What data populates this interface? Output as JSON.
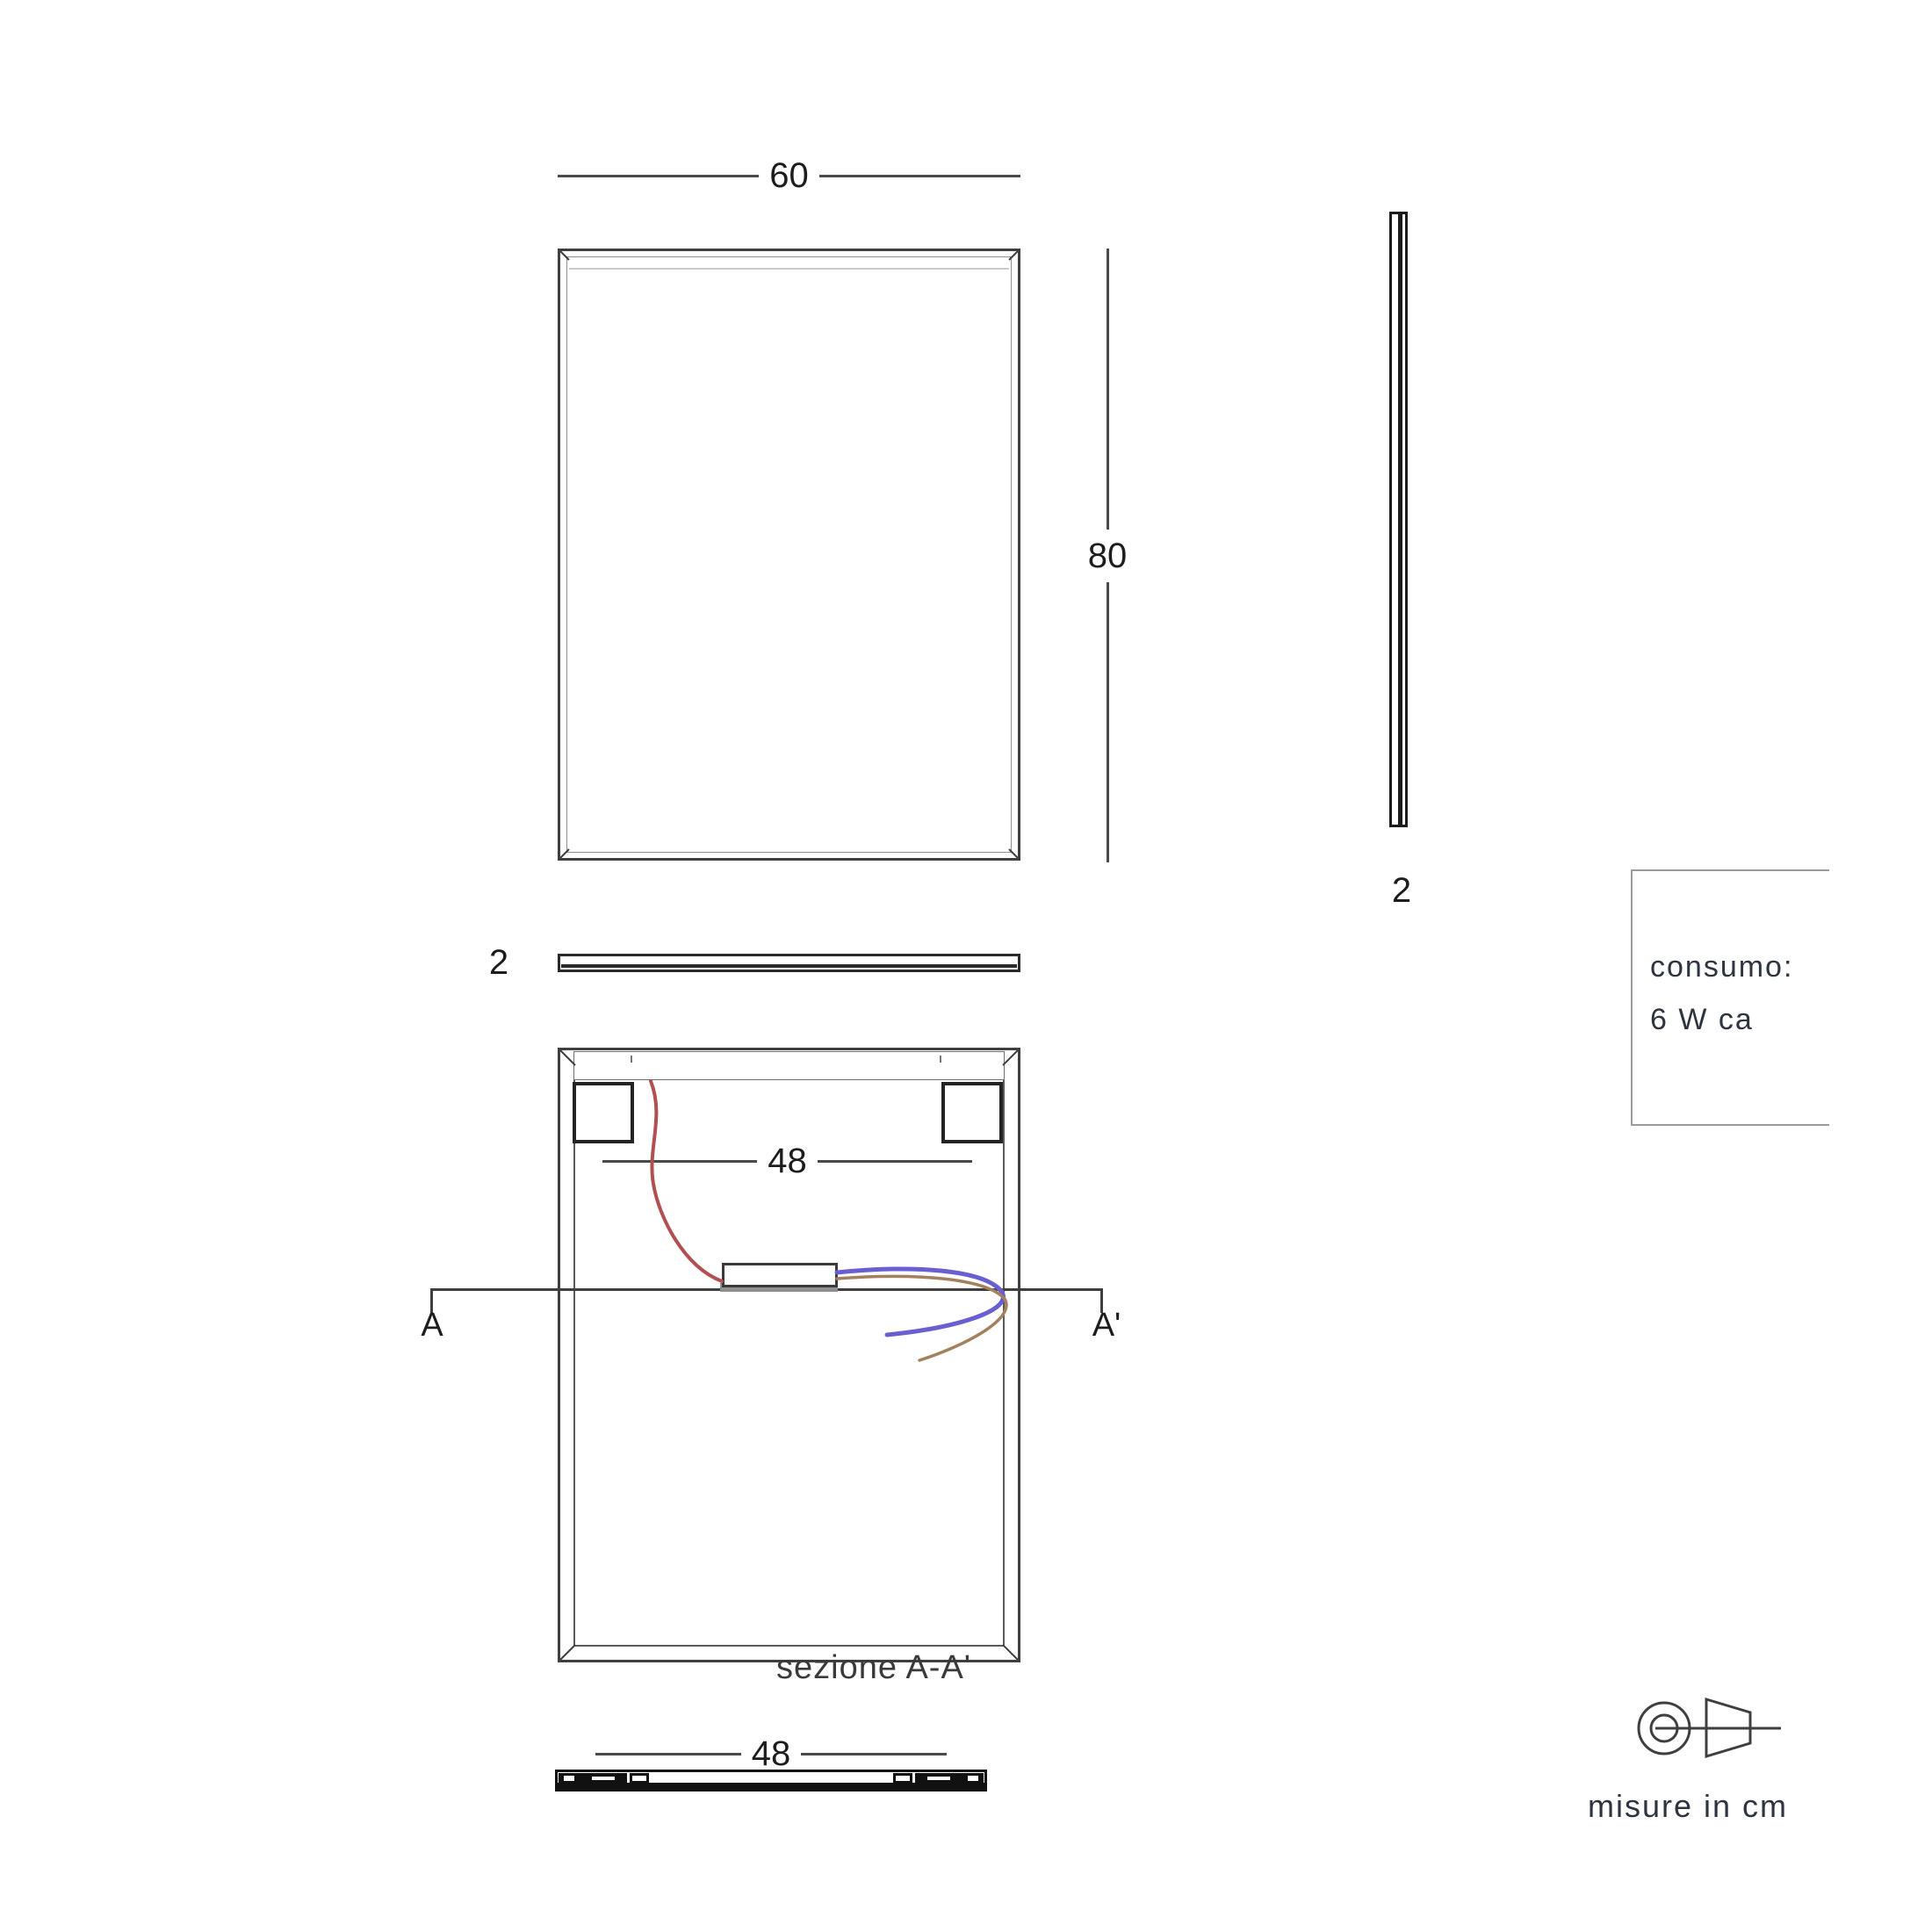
{
  "labels": {
    "front_width": "60",
    "front_height": "80",
    "side_thickness": "2",
    "top_thickness": "2",
    "back_strip_width": "48",
    "section_start": "A",
    "section_end": "A'",
    "section_caption": "sezione A-A'",
    "bottom_width": "48"
  },
  "consumption": {
    "title": "consumo:",
    "value": "6 W ca"
  },
  "note": {
    "units": "misure in cm"
  },
  "colors": {
    "line": "#3f3f3f",
    "wire_red": "#b05050",
    "wire_blue": "#6a5fd0",
    "wire_brown": "#a3815f"
  }
}
